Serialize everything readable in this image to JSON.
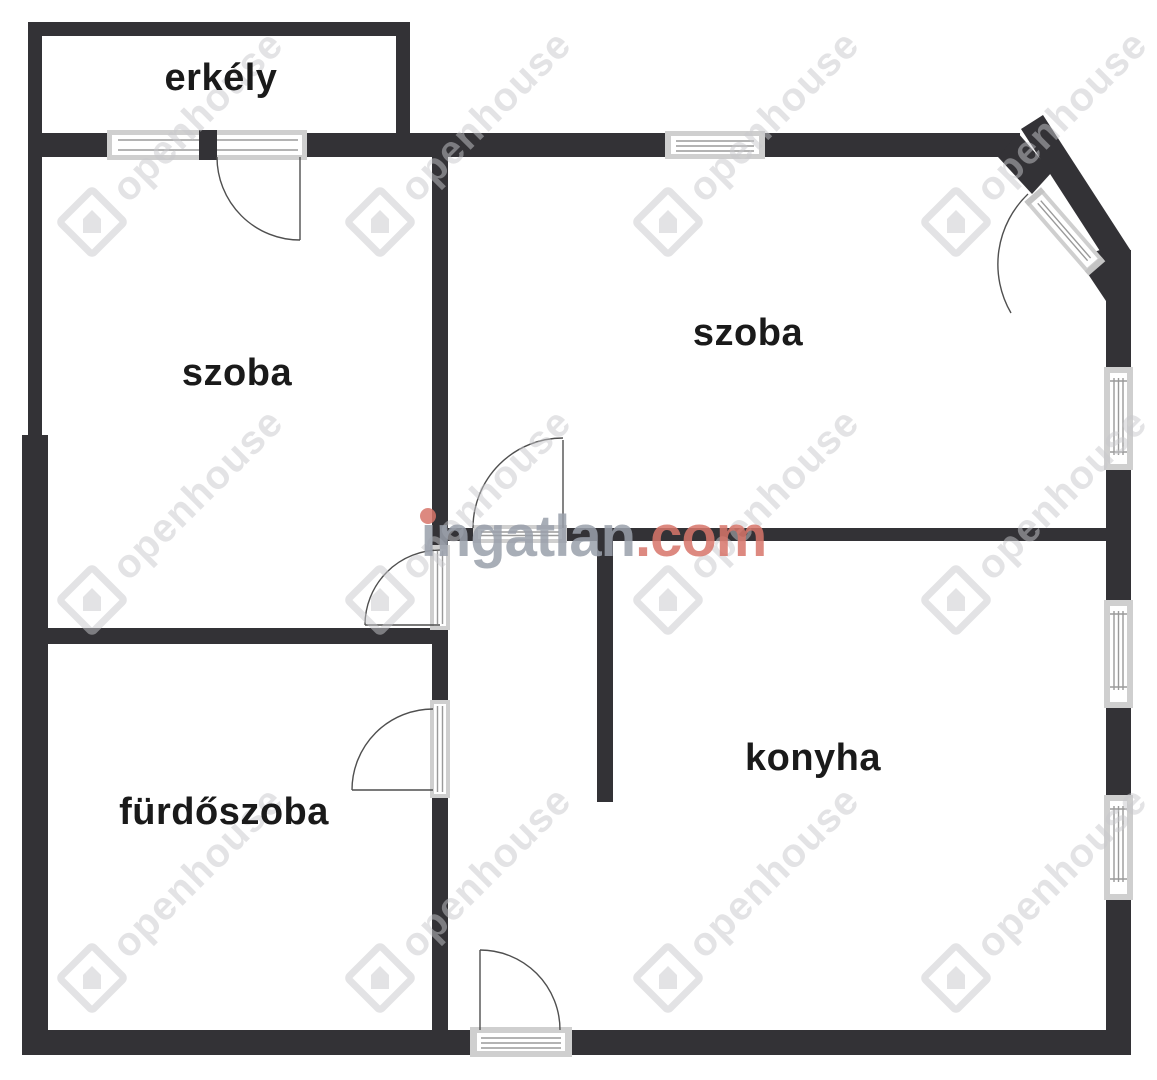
{
  "plan": {
    "rooms": [
      {
        "id": "erkely",
        "label": "erkély"
      },
      {
        "id": "szoba-left",
        "label": "szoba"
      },
      {
        "id": "szoba-right",
        "label": "szoba"
      },
      {
        "id": "furdoszoba",
        "label": "fürdőszoba"
      },
      {
        "id": "konyha",
        "label": "konyha"
      }
    ],
    "watermarks": {
      "brand_name": "ingatlan",
      "brand_tld": ".com",
      "agency": "openhouse"
    },
    "colors": {
      "wall": "#333236",
      "window_frame": "#cfcfcf",
      "label_text": "#1a1a1a",
      "brand_gray": "#9aa0ab",
      "brand_accent": "#d8756a",
      "agency_watermark": "rgba(199,200,204,0.5)"
    }
  }
}
